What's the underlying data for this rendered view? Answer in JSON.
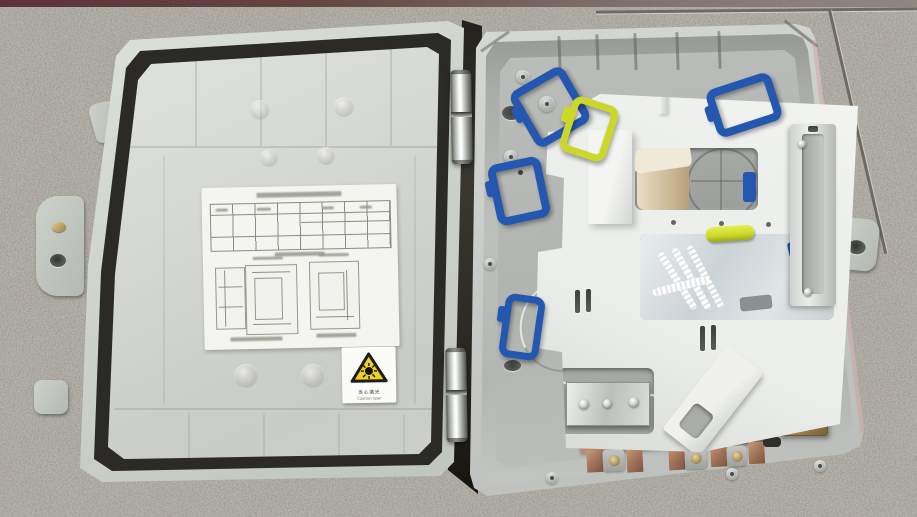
{
  "scene": {
    "subject": "Opened wall-mount fiber optic distribution enclosure lying on a granite tile floor",
    "left_half": "Inside of the lid with black rubber seal gasket, paper specification label and laser warning sticker",
    "right_half": "Enclosure base with white splice tray, blue and yellow cable clips, accessory bag, copper cable comb and ground terminal"
  },
  "stickers": {
    "laser_warning": {
      "line_cn": "当心激光",
      "line_en": "Caution laser"
    }
  },
  "spec_label": {
    "title_legible": false,
    "table_columns": 8,
    "table_rows": 3,
    "diagram_count": 3
  },
  "palette": {
    "floor": "#b1aea6",
    "shell_light": "#d6d9d5",
    "shell_mid": "#c3c6c2",
    "gasket_black": "#2b2a26",
    "tray_white": "#edefec",
    "clip_blue": "#2457b0",
    "clip_yellow": "#ccd829",
    "copper": "#a5765b",
    "brass": "#b0905f",
    "paper_white": "#f4f4f0",
    "warning_yellow": "#f2cf24"
  }
}
